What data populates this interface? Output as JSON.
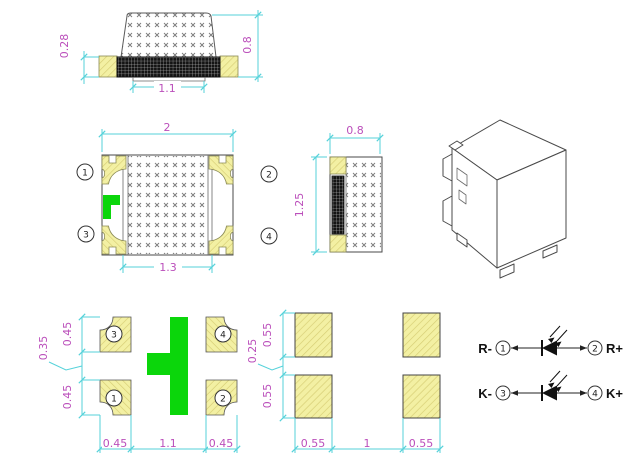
{
  "colors": {
    "dimension_line": "#55d2da",
    "dimension_text": "#bb4fbb",
    "pad_fill": "#f3f0a3",
    "pad_hatch": "#d6cd74",
    "polarity_green": "#0bd60b",
    "body_outline": "#4a4a4a",
    "dark_electrode": "#141414",
    "schematic_text": "#111111"
  },
  "side_view": {
    "dim_left": "0.28",
    "dim_right": "0.8",
    "dim_bottom": "1.1"
  },
  "top_view": {
    "dim_top": "2",
    "dim_bottom": "1.3",
    "pins": [
      "1",
      "2",
      "3",
      "4"
    ]
  },
  "section_view": {
    "dim_top": "0.8",
    "dim_left": "1.25"
  },
  "pad_layout_a": {
    "dim_left_top": "0.45",
    "dim_left_gap": "0.35",
    "dim_left_bottom": "0.45",
    "dim_bottom_left": "0.45",
    "dim_bottom_center": "1.1",
    "dim_bottom_right": "0.45",
    "pins": [
      "3",
      "4",
      "1",
      "2"
    ]
  },
  "pad_layout_b": {
    "dim_left_top": "0.55",
    "dim_left_gap": "0.25",
    "dim_left_bottom": "0.55",
    "dim_bottom_left": "0.55",
    "dim_bottom_center": "1",
    "dim_bottom_right": "0.55"
  },
  "schematic": {
    "rows": [
      {
        "left_label": "R-",
        "left_pin": "1",
        "right_pin": "2",
        "right_label": "R+"
      },
      {
        "left_label": "K-",
        "left_pin": "3",
        "right_pin": "4",
        "right_label": "K+"
      }
    ]
  }
}
